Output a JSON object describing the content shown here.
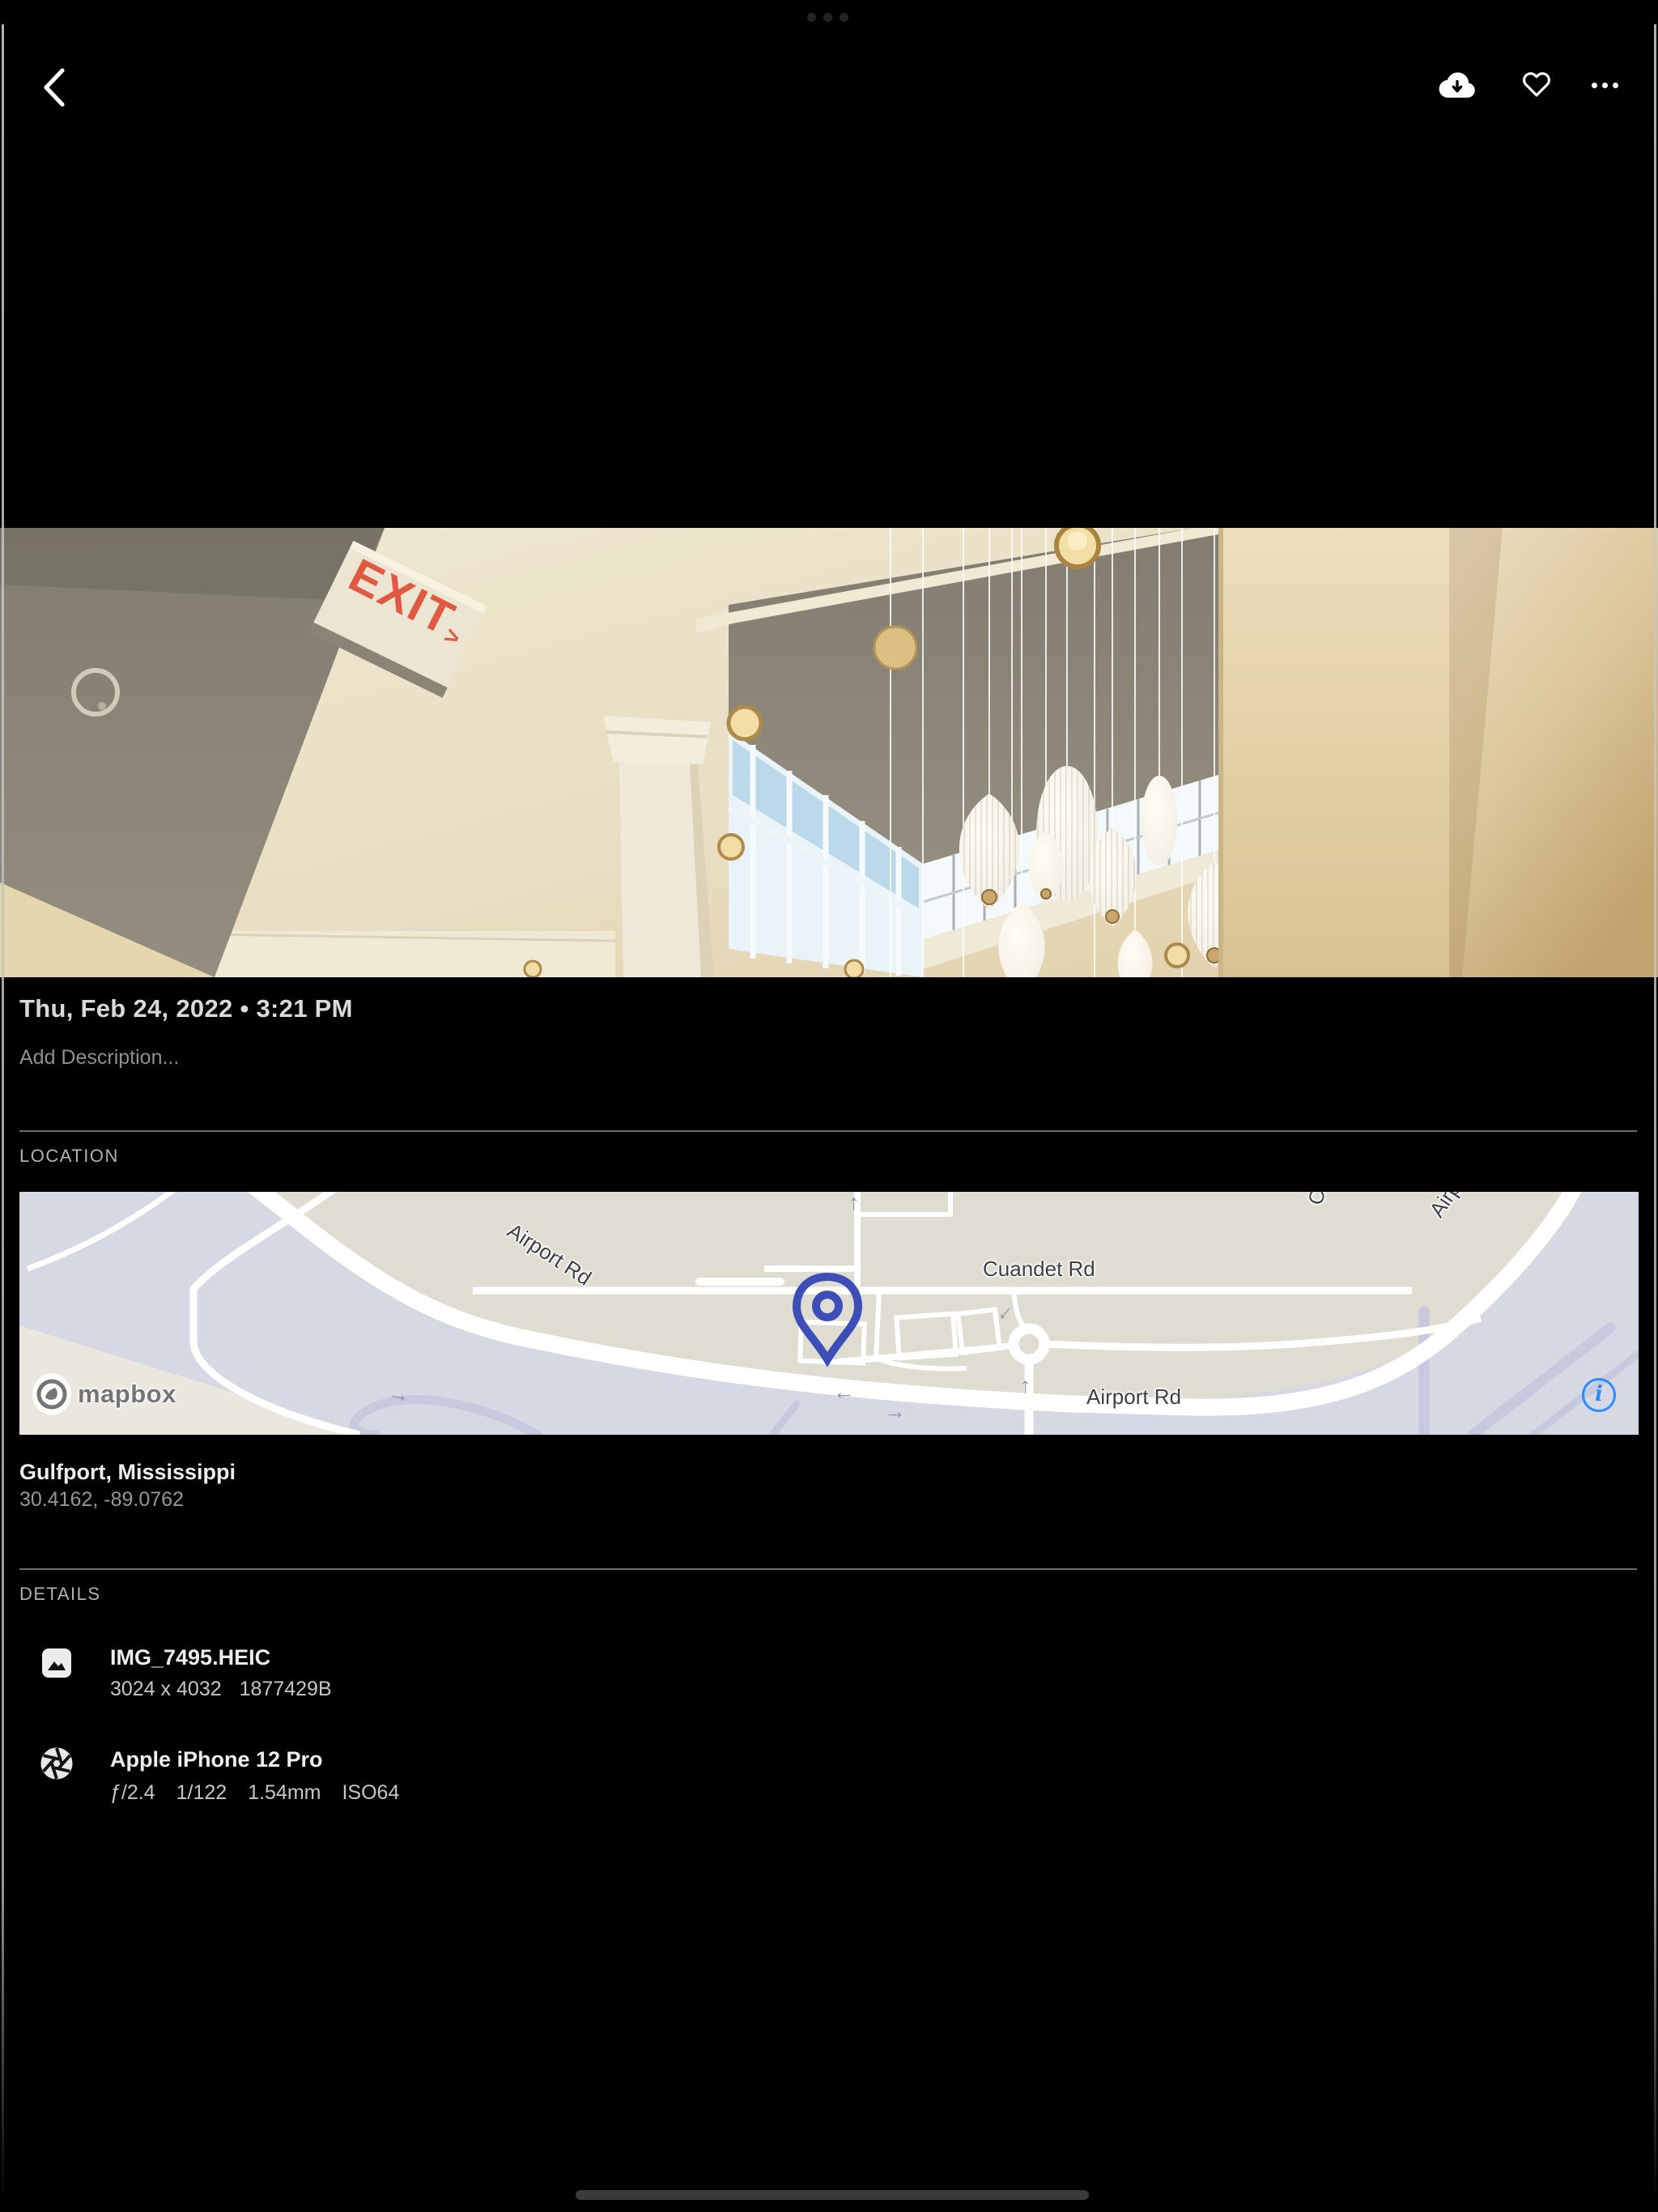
{
  "colors": {
    "background": "#000000",
    "map_info_blue": "#2e8bff",
    "map_pin_indigo": "#3d4eb8",
    "exit_sign_red": "#e05a43"
  },
  "toolbar": {
    "back_icon": "chevron-left",
    "download_icon": "cloud-download",
    "favorite_icon": "heart-outline",
    "more_icon": "ellipsis"
  },
  "photo": {
    "exit_sign": {
      "text": "EXIT",
      "arrow": ">"
    }
  },
  "info": {
    "date_line": "Thu, Feb 24, 2022 • 3:21 PM",
    "description_placeholder": "Add Description..."
  },
  "location": {
    "heading": "LOCATION",
    "place": "Gulfport, Mississippi",
    "coordinates": "30.4162, -89.0762",
    "map": {
      "street_labels": {
        "airport_rd_diագ": "",
        "airport_rd_diag": "Airport Rd",
        "cuandet_rd": "Cuandet Rd",
        "airport_rd_h": "Airport Rd",
        "airport_rd_partial": "Airpo",
        "cu_partial": "Cu"
      },
      "attribution": "mapbox",
      "info_glyph": "i"
    }
  },
  "details": {
    "heading": "DETAILS",
    "file": {
      "name": "IMG_7495.HEIC",
      "dimensions": "3024 x 4032",
      "size": "1877429B"
    },
    "camera": {
      "name": "Apple iPhone 12 Pro",
      "aperture": "ƒ/2.4",
      "shutter": "1/122",
      "focal_length": "1.54mm",
      "iso": "ISO64"
    }
  }
}
